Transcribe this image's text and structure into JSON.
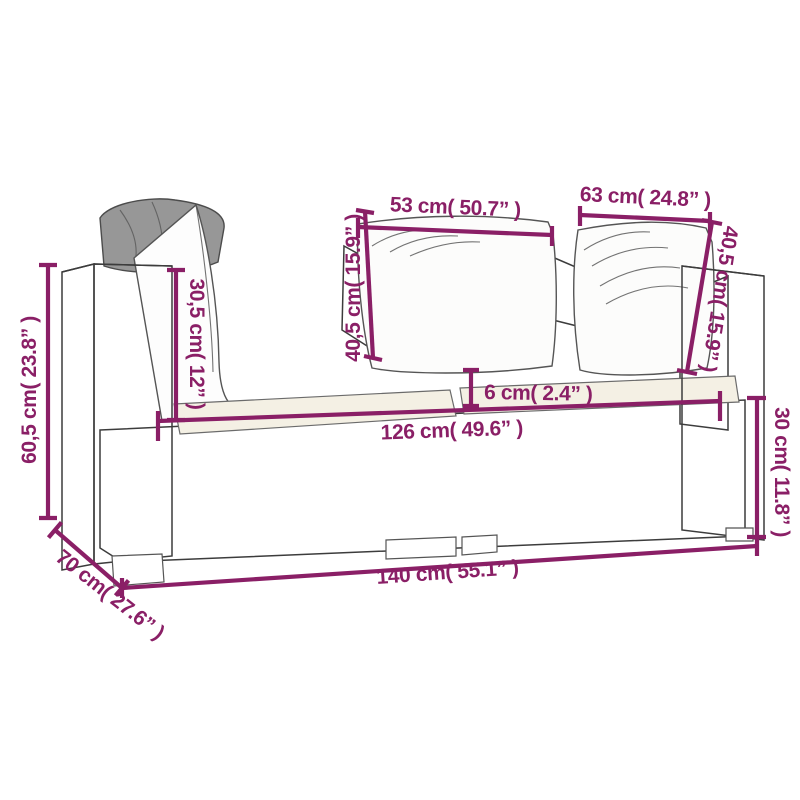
{
  "diagram": {
    "subject": "wicker two-seater garden sofa with back pillows and seat cushions",
    "style": "line-art product dimension drawing"
  },
  "colors": {
    "dimension_accent": "#8a1f66",
    "sketch_line": "#3c3c3c",
    "cushion_cream": "#f4f0e4",
    "pillow_gray": "#979797",
    "background": "#ffffff"
  },
  "labels": {
    "seat_width_left": "53 cm( 50.7” )",
    "seat_width_right": "63 cm( 24.8” )",
    "armrest_above_seat_height": "30,5 cm( 12” )",
    "back_height_center": "40,5 cm( 15.9” )",
    "back_height_right": "40,5 cm( 15.9” )",
    "cushion_thickness": "6 cm( 2.4” )",
    "inner_width": "126 cm( 49.6” )",
    "base_height": "30 cm( 11.8” )",
    "overall_height": "60,5 cm( 23.8” )",
    "overall_width": "140 cm( 55.1” )",
    "overall_depth": "70 cm( 27.6” )"
  }
}
